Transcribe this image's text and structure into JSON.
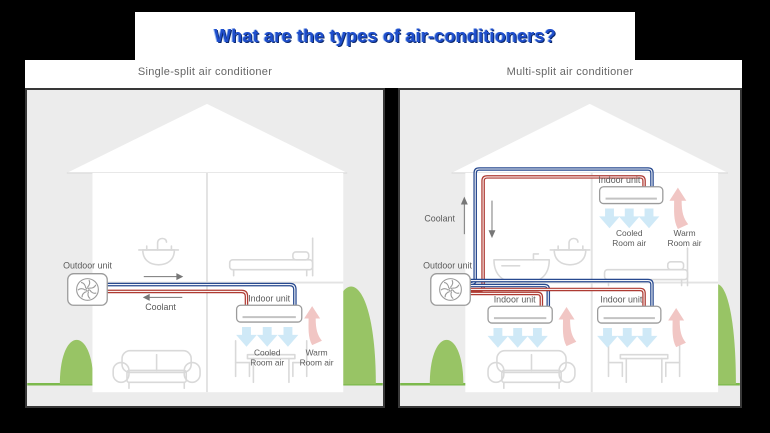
{
  "title": {
    "text": "What are the types of air-conditioners?"
  },
  "panels": [
    {
      "subtitle": "Single-split air conditioner",
      "labels": {
        "outdoor_unit": "Outdoor unit",
        "indoor_unit": "Indoor unit",
        "coolant": "Coolant",
        "cooled": [
          "Cooled",
          "Room air"
        ],
        "warm": [
          "Warm",
          "Room air"
        ]
      }
    },
    {
      "subtitle": "Multi-split air conditioner",
      "labels": {
        "outdoor_unit": "Outdoor unit",
        "indoor_unit": "Indoor unit",
        "coolant": "Coolant",
        "cooled": [
          "Cooled",
          "Room air"
        ],
        "warm": [
          "Warm",
          "Room air"
        ]
      }
    }
  ],
  "colors": {
    "title_blue": "#1f4ecc",
    "coolant_supply_pipe": "#27498f",
    "coolant_return_pipe": "#ae3b33",
    "cooled_air_arrow": "#cfe9f7",
    "warm_air_arrow": "#f1c6c4",
    "bush_green": "#98c465",
    "ground_green": "#7cb94c",
    "panel_background": "#ececec"
  }
}
